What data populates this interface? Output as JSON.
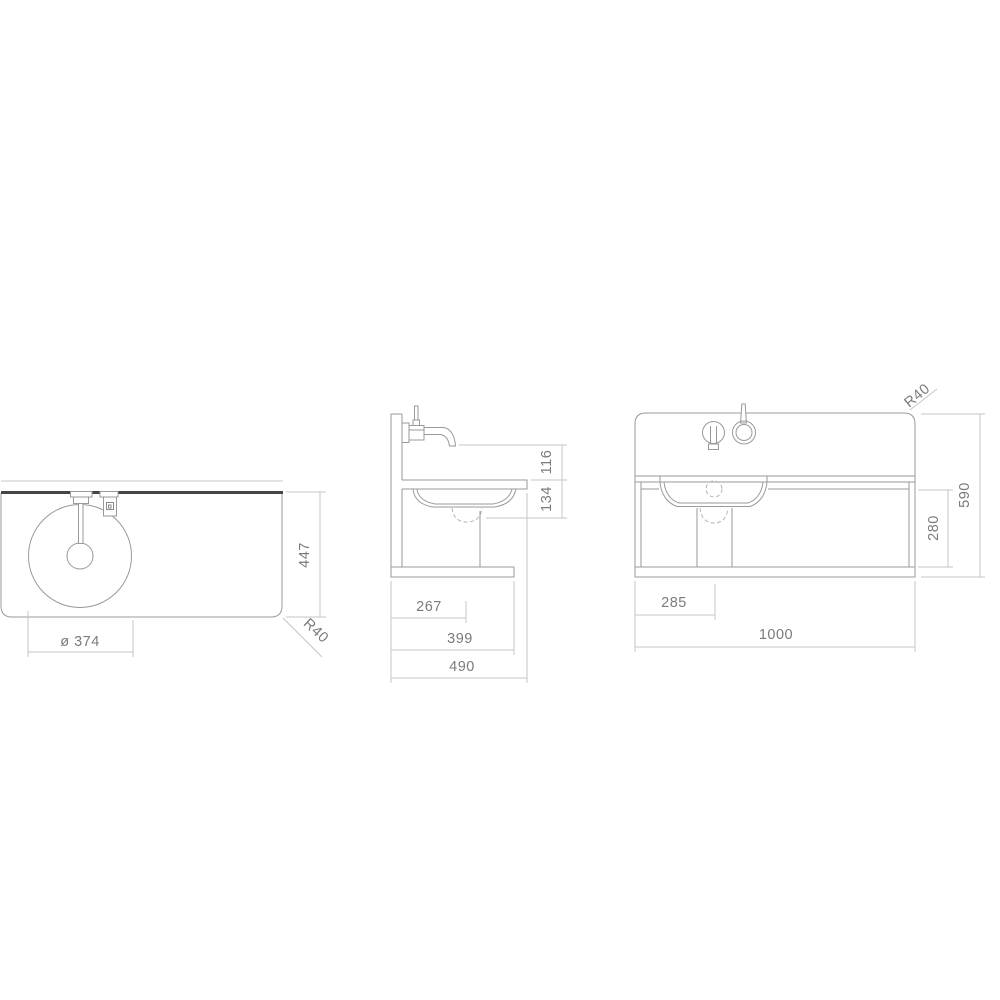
{
  "drawing": {
    "views": {
      "plan": {
        "dims": {
          "basin_diameter": "ø 374",
          "counter_depth": "447",
          "corner_radius": "R40"
        }
      },
      "side": {
        "dims": {
          "spout_height": "116",
          "basin_depth": "134",
          "drain_offset": "267",
          "shelf_depth": "399",
          "total_depth": "490"
        }
      },
      "front": {
        "dims": {
          "corner_radius": "R40",
          "basin_center_offset": "285",
          "total_width": "1000",
          "under_counter_height": "280",
          "total_height": "590"
        }
      }
    },
    "colors": {
      "background": "#ffffff",
      "object_line": "#9a9a9a",
      "heavy_line": "#454545",
      "dimension_line": "#c4c4c4",
      "dimension_text": "#7b7b7b"
    }
  }
}
